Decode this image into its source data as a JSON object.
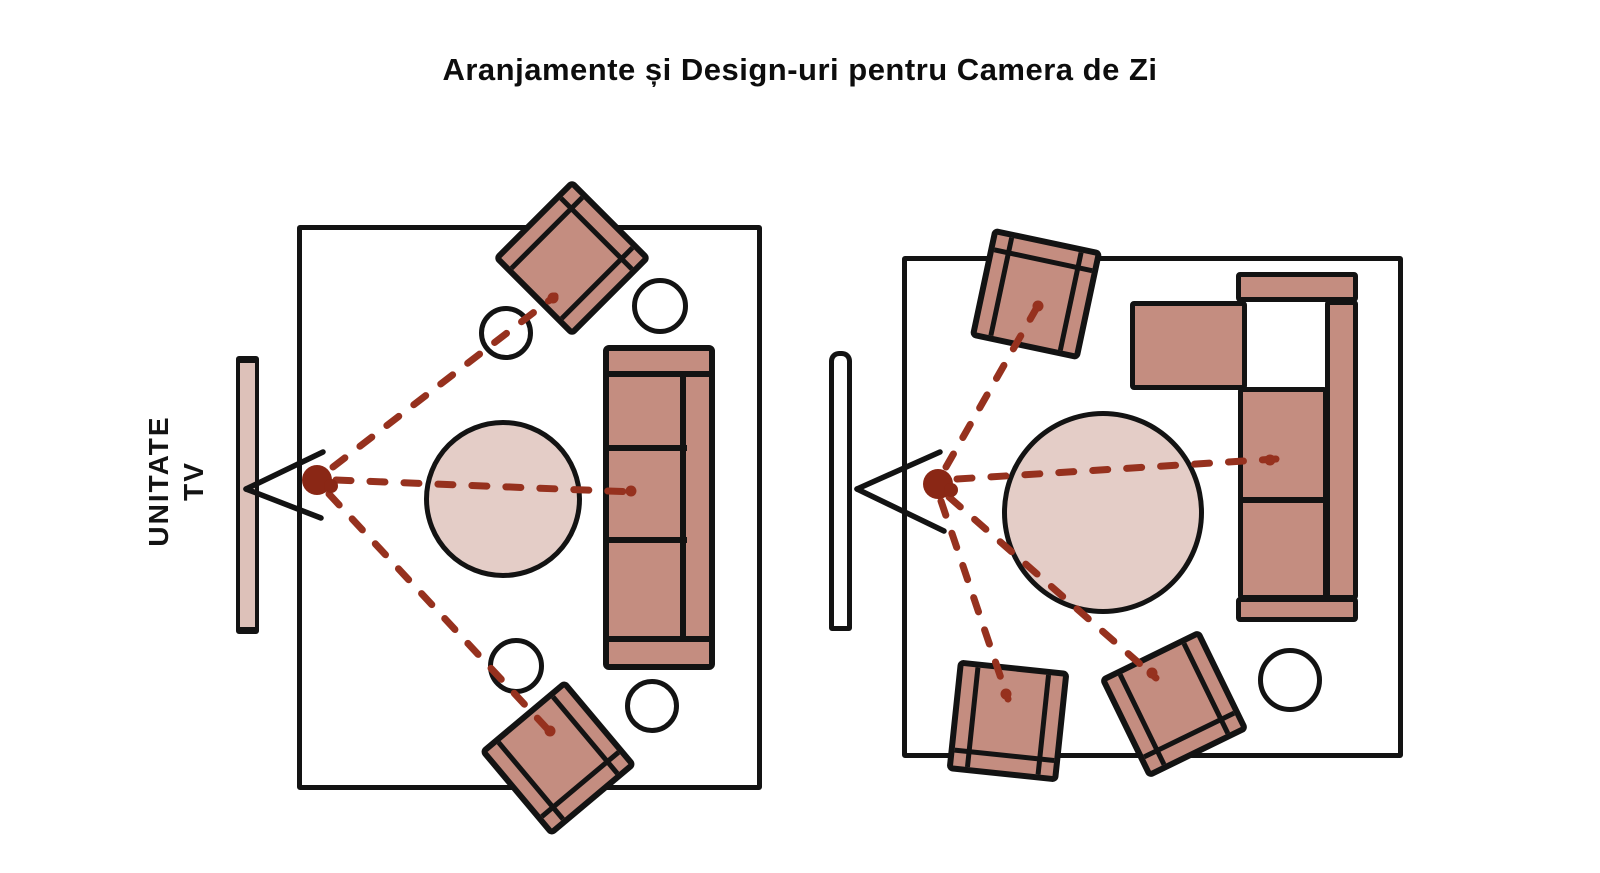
{
  "title": "Aranjamente și Design-uri pentru Camera de Zi",
  "tv_unit": {
    "line1": "UNITATE",
    "line2": "TV"
  },
  "palette": {
    "furniture_fill": "#c48d80",
    "table_fill": "#e4cdc7",
    "tv_unit_fill": "#ddc1b9",
    "outline": "#131313",
    "sight_line": "#96311e",
    "viewer_dot": "#8a2715",
    "background": "#ffffff"
  },
  "figures": [
    {
      "id": "layout-1",
      "position": "left",
      "items": [
        "tv-unit",
        "viewing-angle-marker",
        "viewer-dot",
        "round-coffee-table",
        "three-seat-sofa",
        "armchair x2",
        "side-table x4",
        "sight-lines x3"
      ]
    },
    {
      "id": "layout-2",
      "position": "right",
      "items": [
        "tv-unit",
        "viewing-angle-marker",
        "viewer-dot",
        "large-round-table",
        "l-shaped-sectional-sofa",
        "armchair x3",
        "side-table x1",
        "sight-lines x4"
      ]
    }
  ]
}
